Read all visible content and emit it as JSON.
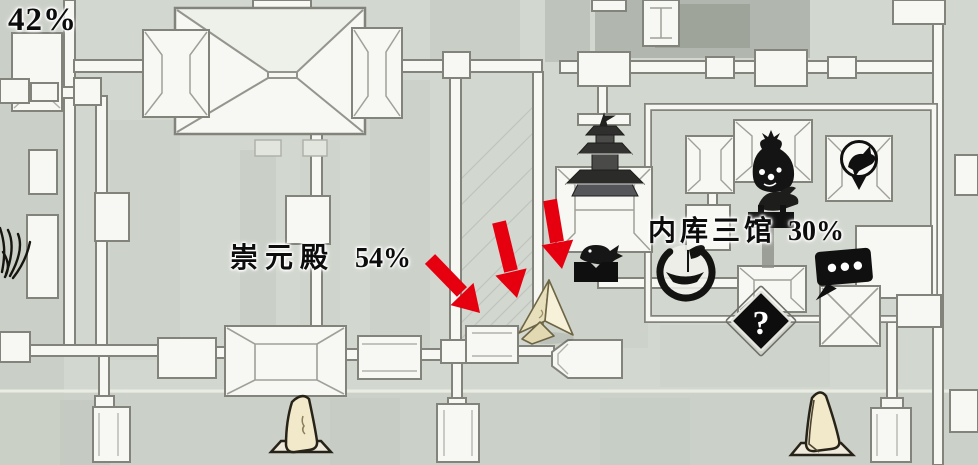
{
  "hud": {
    "zone_completion": "42%"
  },
  "labels": {
    "hall": {
      "name": "崇元殿",
      "percent": "54%"
    },
    "treasury": {
      "name": "内库三馆",
      "percent": "30%"
    },
    "question_glyph": "?"
  },
  "icons": {
    "question_diamond": {
      "glyph": "?",
      "meaning": "unexplored-location"
    },
    "dialogue": "speech-bubble-three-dots",
    "money_bag": "money-pouch-marker",
    "bird_pin": "bird-map-pin",
    "boat_circle": "boat-ink-swirl-marker",
    "fish_stall": "fish-on-stand-marker",
    "bird_perch": "bird-on-stand-marker",
    "pagoda": "pagoda-landmark",
    "stele_left": "stone-stele-landmark",
    "stele_right": "stone-stele-landmark",
    "player": "player-position-cursor",
    "arrows": "red-guidance-arrows"
  },
  "colors": {
    "arrow_red": "#e6000f",
    "paper_background": "#d2d7cf",
    "building_fill": "#f7f7f3",
    "wall_outline": "#82837b",
    "ink_black": "#111111",
    "stele_fill": "#f2e8ca",
    "player_marker_fill": "#f3ecd2"
  }
}
